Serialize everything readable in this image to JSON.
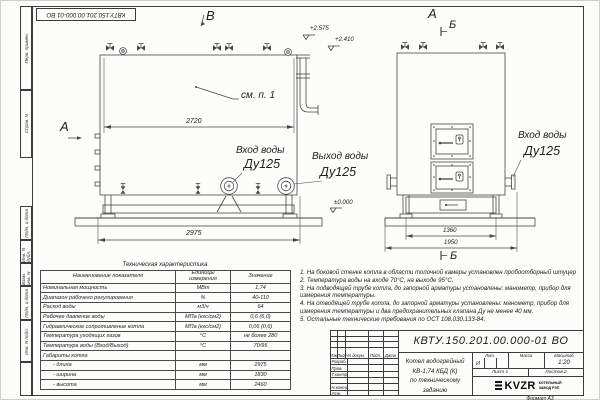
{
  "stamp_top": "КВТУ.150.201.00.000-01  ВО",
  "views": {
    "side": {
      "label_v": "В",
      "label_a": "А",
      "note_ref": "см. п. 1",
      "dim_body": "2720",
      "dim_total": "2975",
      "elev1": "+2.575",
      "elev2": "+2.410",
      "elev_zero": "±0.000",
      "inlet_label": "Вход воды",
      "inlet_dn": "Ду125",
      "outlet_label": "Выход воды",
      "outlet_dn": "Ду125"
    },
    "front": {
      "label_a": "А",
      "label_b_top": "Б",
      "label_b_bottom": "Б",
      "dim_legs": "1360",
      "dim_base": "1950",
      "inlet_label": "Вход воды",
      "inlet_dn": "Ду125"
    }
  },
  "tech_table": {
    "title": "Техническая характеристика",
    "headers": [
      "Наименование показателя",
      "Единицы измерения",
      "Значение"
    ],
    "rows": [
      [
        "Номинальная мощность",
        "МВт",
        "1,74"
      ],
      [
        "Диапазон рабочего регулирования",
        "%",
        "40-110"
      ],
      [
        "Расход воды",
        "м3/ч",
        "64"
      ],
      [
        "Рабочее давление воды",
        "МПа (кгс/см2)",
        "0,6 (6,0)"
      ],
      [
        "Гидравлическое сопротивление котла",
        "МПа (кгс/см2)",
        "0,06 (0,6)"
      ],
      [
        "Температура уходящих газов",
        "°С",
        "не более 280"
      ],
      [
        "Температура воды (Вход/Выход)",
        "°С",
        "70/95"
      ],
      [
        "Габариты котла",
        "",
        ""
      ],
      [
        "- длина",
        "мм",
        "2975"
      ],
      [
        "- ширина",
        "мм",
        "1830"
      ],
      [
        "- высота",
        "мм",
        "2460"
      ]
    ]
  },
  "notes": [
    "1.  На боковой стенке котла в области топочной камеры установлен пробоотборный штуцер",
    "2.  Температура воды на входе 70°С,  на выходе  95°С.",
    "3.  На подводящей трубе котла, до запорной арматуры установлены: манометр, прибор для измерения температуры.",
    "4.  На отводящей трубе котла, до запорной арматуры установлены: манометр, прибор для измерения температуры и два предохранительных клапана  Ду не менее  40 мм.",
    "5.  Остальные технические требования по ОСТ 108.030.133-84."
  ],
  "title_block": {
    "doc_number": "КВТУ.150.201.00.000-01  ВО",
    "name_line1": "Котел водогрейный",
    "name_line2": "КВ-1,74 КБД (К)",
    "name_line3": "по техническому заданию",
    "col_izm": "Изм.",
    "col_list": "Лист",
    "col_doc": "N докум.",
    "col_podp": "Подп.",
    "col_data": "Дата",
    "row_razrab": "Разраб.",
    "row_prov": "Пров.",
    "row_tkontr": "Т.контр.",
    "row_nkontr": "Н.контр.",
    "row_utv": "Утв.",
    "lit_label": "Лит.",
    "lit_value": "И",
    "mass_label": "Масса",
    "scale_label": "Масштаб",
    "scale_value": "1:20",
    "sheet": "Лист 1",
    "sheets": "Листов 2",
    "logo_text": "KVZR",
    "logo_sub1": "КОТЕЛЬНЫЙ",
    "logo_sub2": "ЗАВОД РЭП",
    "format": "Формат  А3"
  },
  "margin_labels": [
    "Перв. примен.",
    "Справ. N",
    "Подп. и дата",
    "Инв. N дубл.",
    "Взам. инв. N",
    "Подп. и дата",
    "Инв. N подл."
  ]
}
